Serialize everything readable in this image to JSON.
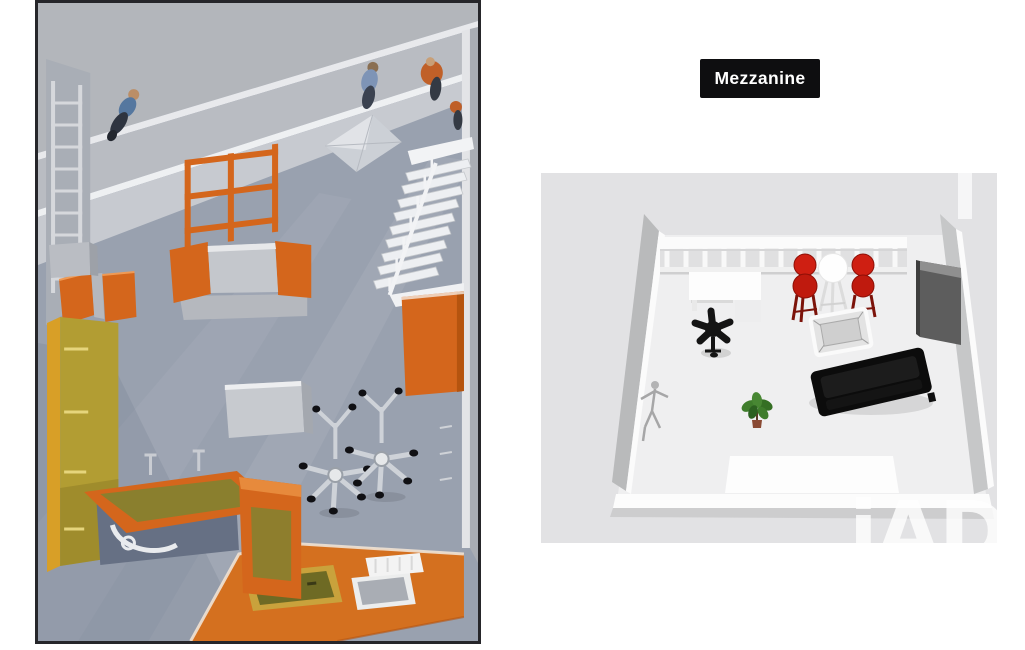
{
  "page": {
    "background": "#ffffff"
  },
  "labels": {
    "mezzanine": "Mezzanine"
  },
  "watermark": {
    "text": "iAD"
  },
  "panels": {
    "left": "3d-interior-render",
    "right": "mezzanine-3d-floorplan"
  },
  "colors": {
    "label_bg": "#0e0e10",
    "label_text": "#ffffff",
    "panel_bg": "#e2e2e4",
    "accent_orange": "#d4661c",
    "platform_orange": "#d4701f",
    "stool_red": "#cf1f12",
    "sofa_black": "#0c0c0c",
    "plant_green": "#3f7d2c",
    "cabinet_yellow": "#b29d33",
    "render_floor": "#99a1af",
    "watermark_white": "#ffffff"
  }
}
